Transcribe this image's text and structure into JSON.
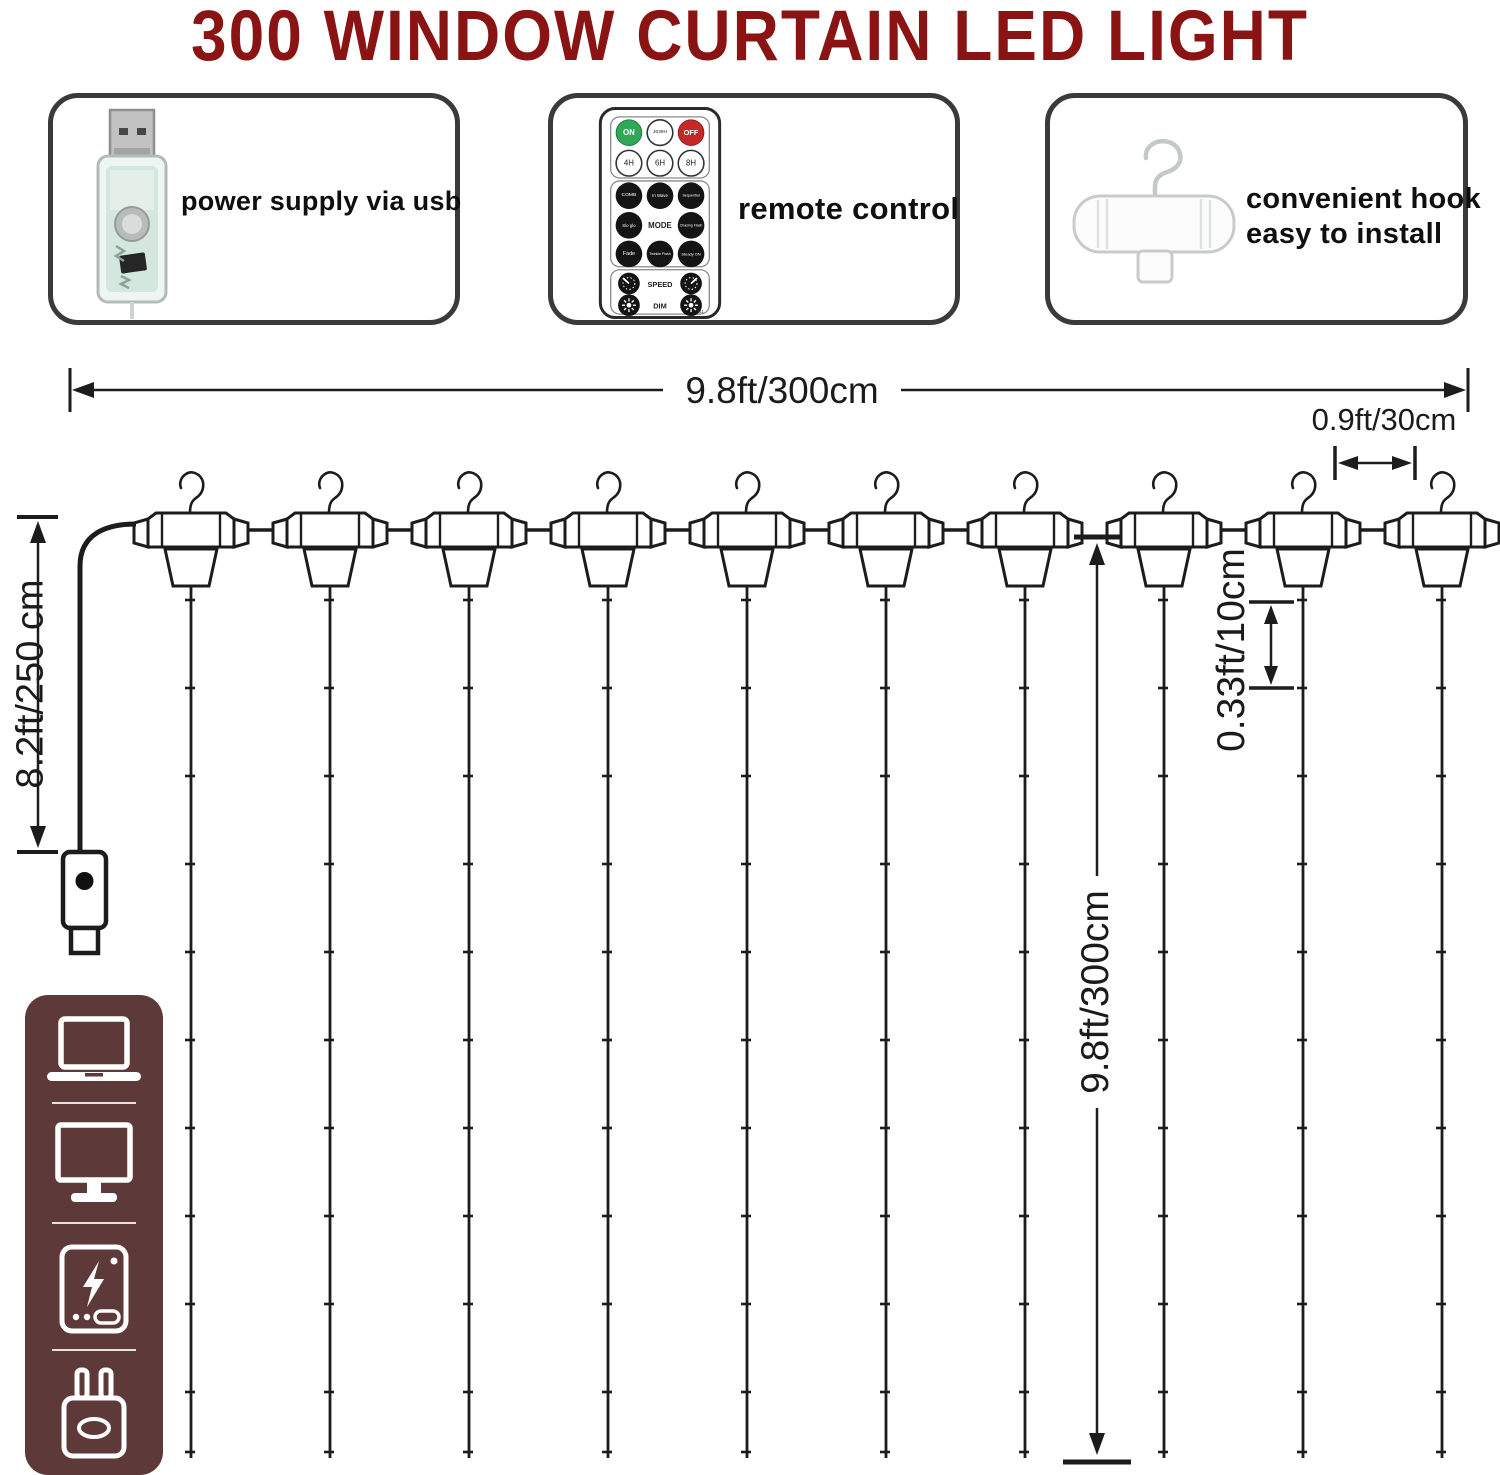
{
  "title": "300 WINDOW CURTAIN LED LIGHT",
  "features": {
    "power": {
      "icon": "usb-plug-photo",
      "label": "power supply via usb"
    },
    "remote": {
      "icon": "remote-control-photo",
      "label": "remote control"
    },
    "hook": {
      "icon": "hanging-hook-photo",
      "label_line1": "convenient hook",
      "label_line2": "easy to install"
    }
  },
  "remote": {
    "row_power": [
      "ON",
      "J639H",
      "OFF"
    ],
    "row_timer": [
      "4H",
      "6H",
      "8H"
    ],
    "row_mode_1": [
      "COMB",
      "In Wave",
      "Sequential"
    ],
    "row_mode_2": [
      "Slo glo",
      "MODE",
      "Chasing Flash"
    ],
    "row_mode_3": [
      "Fade",
      "Twinkle Flash",
      "Steady ON"
    ],
    "speed_label": "SPEED",
    "dim_label": "DIM",
    "footnote": "111"
  },
  "dimensions": {
    "curtain_width": "9.8ft/300cm",
    "string_spacing": "0.9ft/30cm",
    "power_cord_length": "8.2ft/250 cm",
    "curtain_drop": "9.8ft/300cm",
    "led_spacing": "0.33ft/10cm"
  },
  "diagram": {
    "hook_count": 10,
    "string_count": 10,
    "led_ticks_per_string": 10
  },
  "sidebar": {
    "icons": [
      "laptop-icon",
      "monitor-icon",
      "power-bank-icon",
      "usb-wall-adapter-icon"
    ]
  },
  "colors": {
    "title": "#8a1414",
    "line_art": "#1c1c1c",
    "box_border": "#3a3a3a",
    "sidebar_bg": "#5e3939",
    "remote_on_green": "#2ea757",
    "remote_off_red": "#c62828"
  }
}
